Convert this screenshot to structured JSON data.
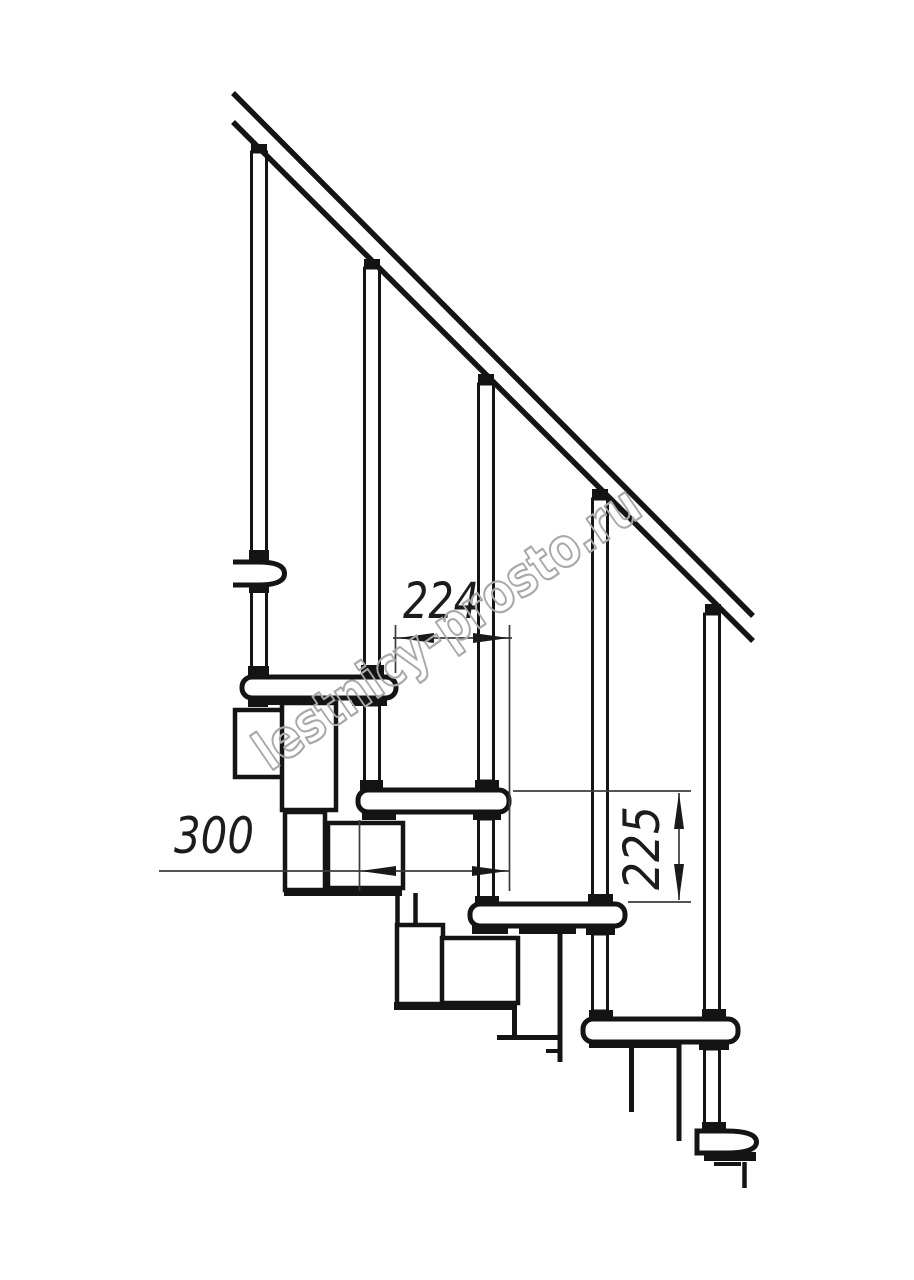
{
  "page": {
    "background": "#ffffff",
    "width": 914,
    "height": 1280
  },
  "drawing": {
    "description_visible_text_only": "",
    "watermark": {
      "text": "lestnicy-prosto.ru",
      "color": "#a8a8a8"
    },
    "dimensions": {
      "step_run": {
        "value": "224"
      },
      "tread_depth": {
        "value": "300"
      },
      "step_rise": {
        "value": "225"
      }
    },
    "colors": {
      "line": "#141414",
      "dimension_line": "#3b3b3b",
      "dimension_text": "#1c1c1c",
      "watermark": "#a8a8a8",
      "background": "#ffffff"
    }
  }
}
